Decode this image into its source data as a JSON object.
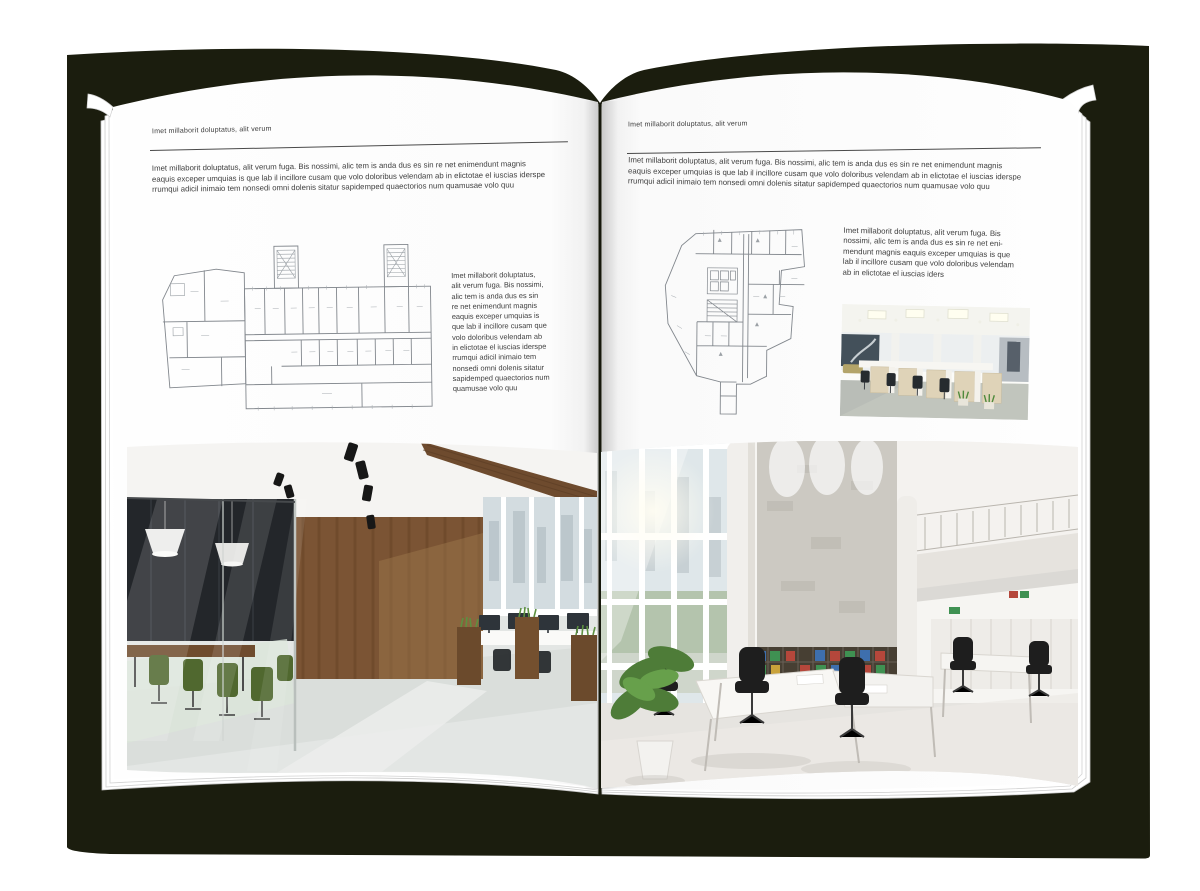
{
  "document": {
    "type": "open-magazine-spread-mockup",
    "colors": {
      "cover": "#1b1d0e",
      "page": "#ffffff",
      "text": "#3e3e3e",
      "rule": "#4a4a4a",
      "wood": "#7b5434",
      "chair_green": "#50682f",
      "binder_red": "#b5473b",
      "binder_green": "#3f9152",
      "binder_blue": "#3e6fad"
    },
    "pages": {
      "left": {
        "header": "Imet millaborit doluptatus, alit verum",
        "intro": "Imet millaborit doluptatus, alit verum fuga. Bis nossimi, alic tem is anda dus es sin re net enimendunt magnis\neaquis exceper umquias is que lab il incillore cusam que volo doloribus velendam ab in elictotae el iuscias iderspe\nrrumqui adicil inimaio tem nonsedi omni dolenis sitatur sapidemped quaectorios num quamusae volo quu",
        "side_text": "Imet millaborit doluptatus,\nalit verum fuga. Bis nossimi,\nalic tem is anda dus es sin\nre net enimendunt magnis\neaquis exceper umquias is\nque lab il incillore cusam que\nvolo doloribus velendam ab\nin elictotae el iuscias iderspe\nrrumqui adicil inimaio tem\nnonsedi omni dolenis sitatur\nsapidemped quaectorios num\nquamusae volo quu",
        "figures": {
          "floor_plan": "architectural-floor-plan-drawing",
          "photo": "office-interior-wood-and-glass-photo"
        }
      },
      "right": {
        "header": "Imet millaborit doluptatus, alit verum",
        "intro": "Imet millaborit doluptatus, alit verum fuga. Bis nossimi, alic tem is anda dus es sin re net enimendunt magnis\neaquis exceper umquias is que lab il incillore cusam que volo doloribus velendam ab in elictotae el iuscias iderspe\nrrumqui adicil inimaio tem nonsedi omni dolenis sitatur sapidemped quaectorios num quamusae volo quu",
        "side_text": "Imet millaborit doluptatus, alit verum fuga. Bis\nnossimi, alic tem is anda dus es sin re net eni-\nmendunt magnis eaquis exceper umquias is que\nlab il incillore cusam que volo doloribus velendam\nab in elictotae el iuscias iders",
        "figures": {
          "floor_plan": "architectural-floor-plan-drawing",
          "small_photo": "open-plan-workstations-photo",
          "photo": "bright-atrium-office-photo"
        }
      }
    }
  }
}
